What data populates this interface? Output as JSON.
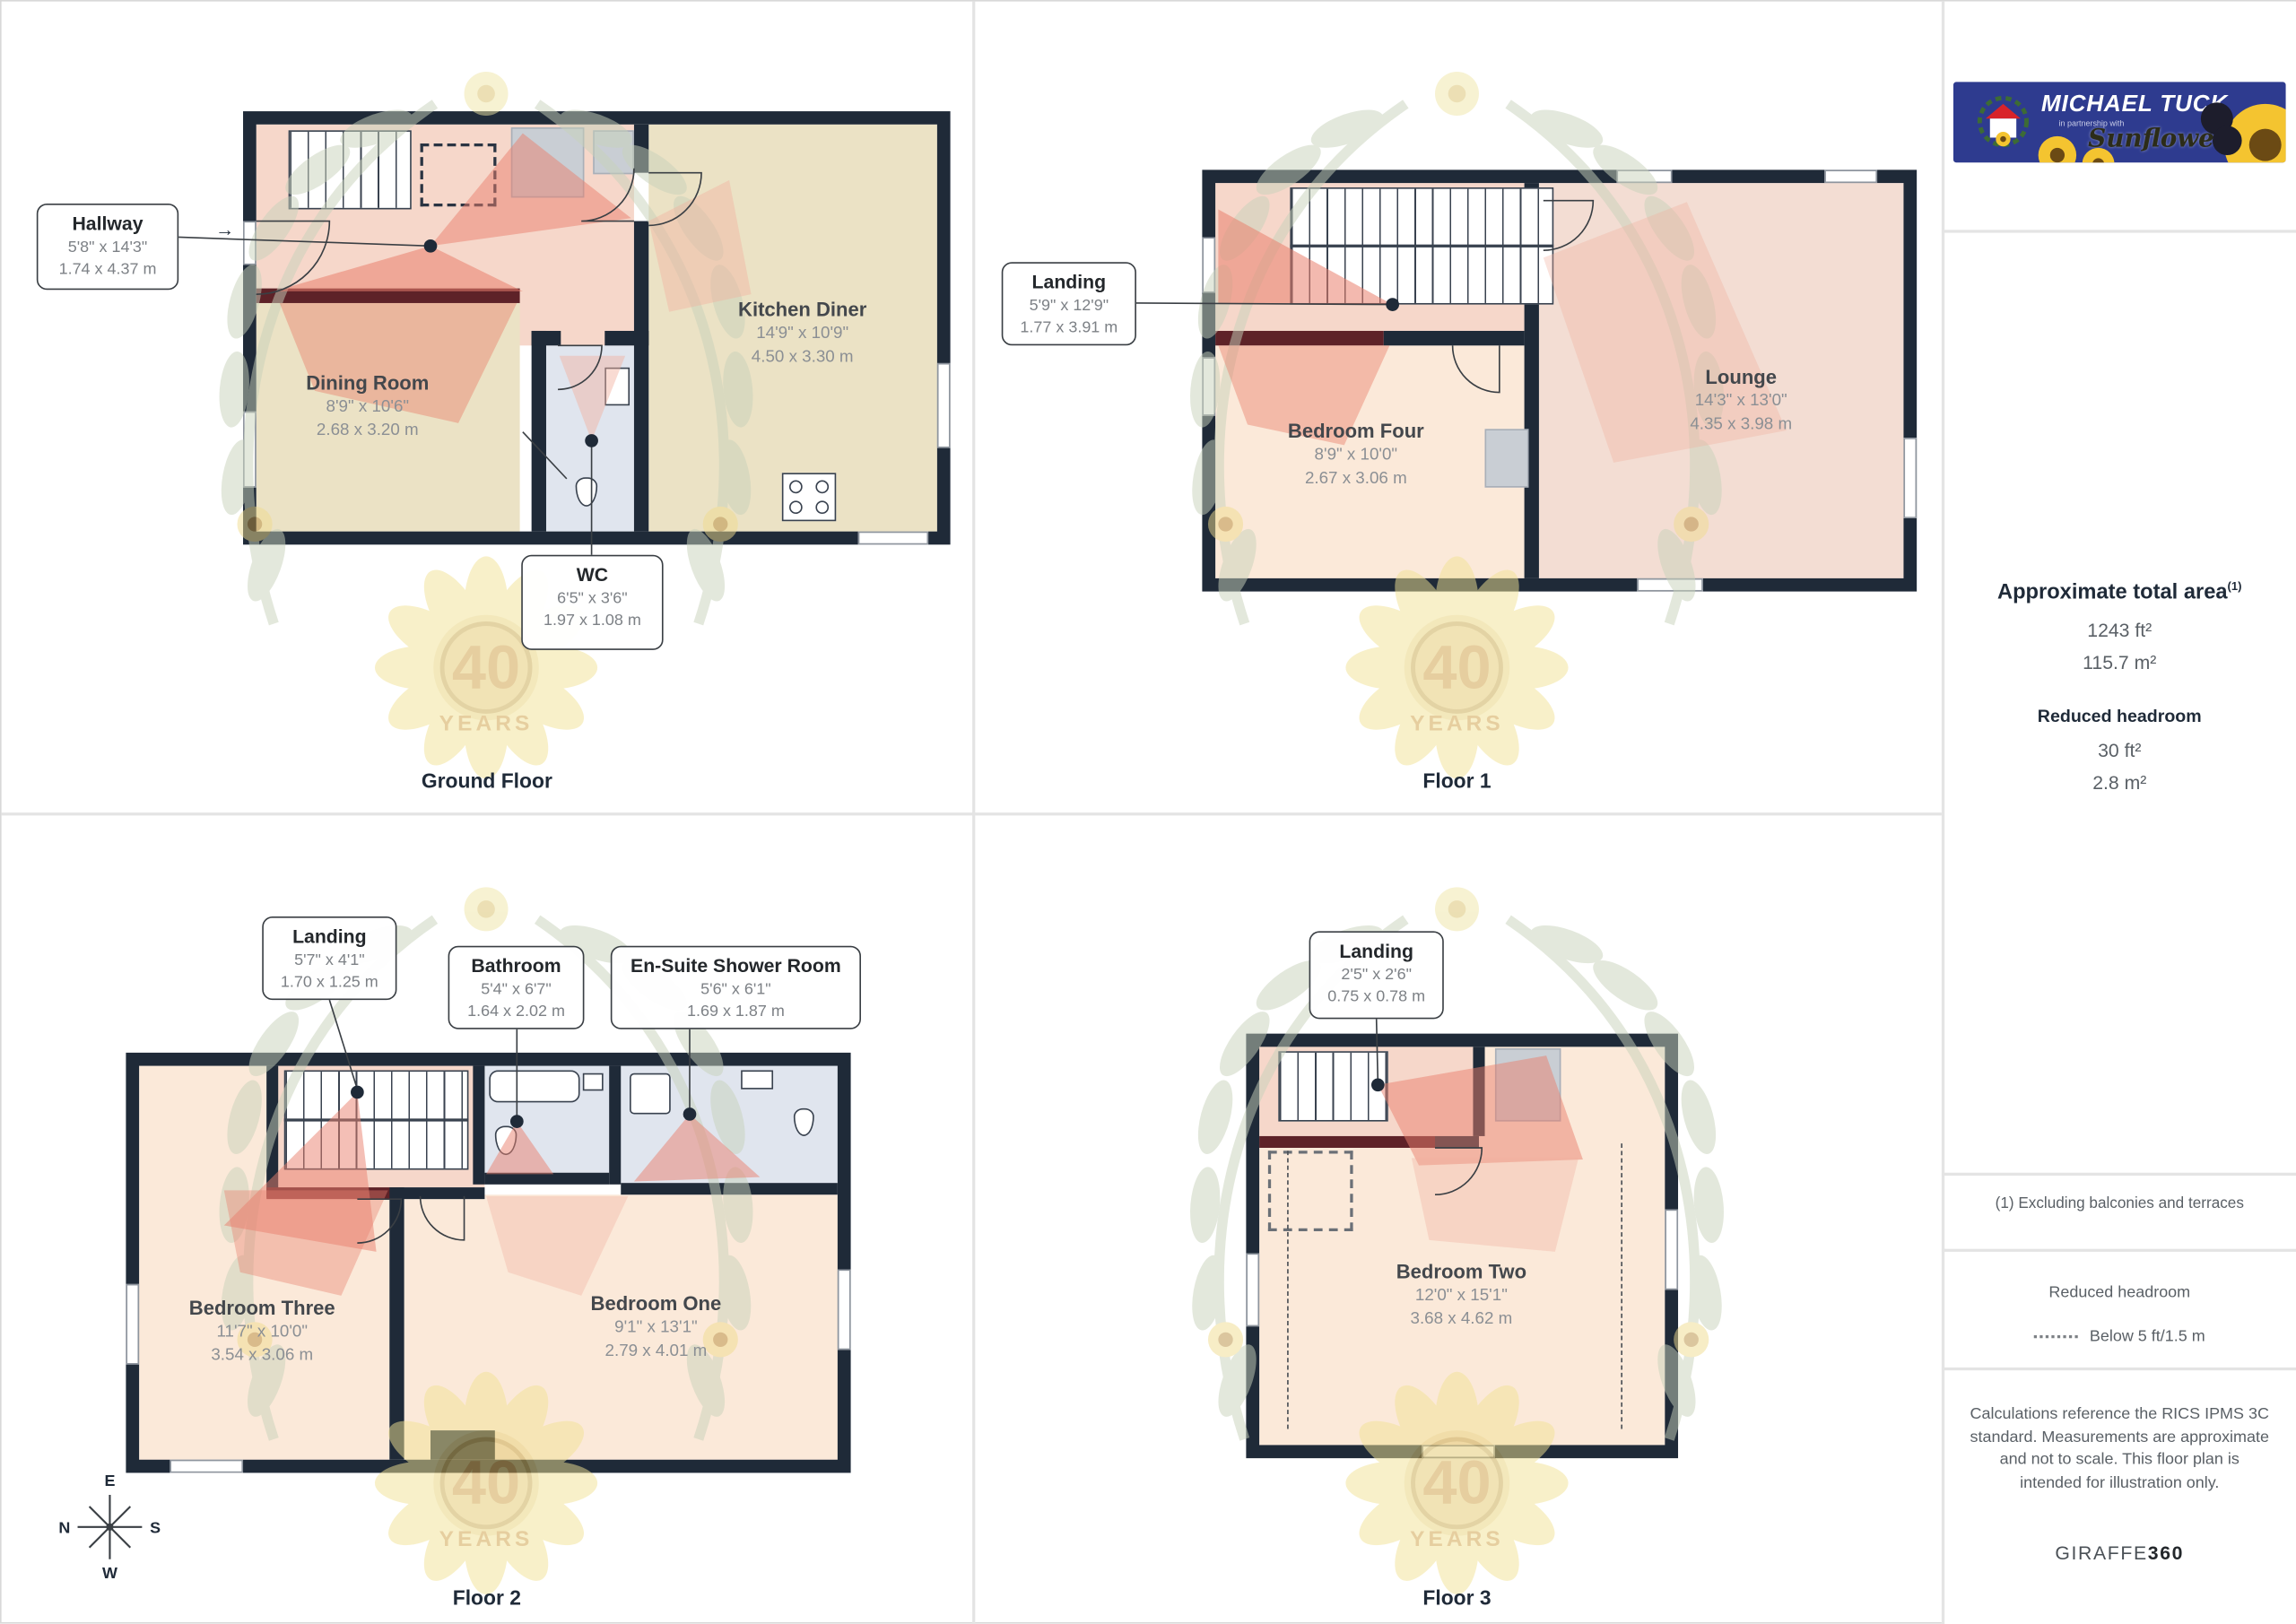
{
  "watermark": {
    "top": "40",
    "bottom": "YEARS"
  },
  "icons": {
    "entry_arrow": "→"
  },
  "compass": {
    "e": "E",
    "n": "N",
    "s": "S",
    "w": "W"
  },
  "panels": [
    {
      "floor_label": "Ground Floor",
      "rooms": {
        "hallway": {
          "name": "Hallway",
          "imperial": "5'8\" x 14'3\"",
          "metric": "1.74 x 4.37 m"
        },
        "dining": {
          "name": "Dining Room",
          "imperial": "8'9\" x 10'6\"",
          "metric": "2.68 x 3.20 m"
        },
        "kitchen": {
          "name": "Kitchen Diner",
          "imperial": "14'9\" x 10'9\"",
          "metric": "4.50 x 3.30 m"
        },
        "wc": {
          "name": "WC",
          "imperial": "6'5\" x 3'6\"",
          "metric": "1.97 x 1.08 m"
        }
      }
    },
    {
      "floor_label": "Floor 1",
      "rooms": {
        "landing": {
          "name": "Landing",
          "imperial": "5'9\" x 12'9\"",
          "metric": "1.77 x 3.91 m"
        },
        "bedroom_four": {
          "name": "Bedroom Four",
          "imperial": "8'9\" x 10'0\"",
          "metric": "2.67 x 3.06 m"
        },
        "lounge": {
          "name": "Lounge",
          "imperial": "14'3\" x 13'0\"",
          "metric": "4.35 x 3.98 m"
        }
      }
    },
    {
      "floor_label": "Floor 2",
      "rooms": {
        "landing": {
          "name": "Landing",
          "imperial": "5'7\" x 4'1\"",
          "metric": "1.70 x 1.25 m"
        },
        "bathroom": {
          "name": "Bathroom",
          "imperial": "5'4\" x 6'7\"",
          "metric": "1.64 x 2.02 m"
        },
        "ensuite": {
          "name": "En-Suite Shower Room",
          "imperial": "5'6\" x 6'1\"",
          "metric": "1.69 x 1.87 m"
        },
        "bedroom_three": {
          "name": "Bedroom Three",
          "imperial": "11'7\" x 10'0\"",
          "metric": "3.54 x 3.06 m"
        },
        "bedroom_one": {
          "name": "Bedroom One",
          "imperial": "9'1\" x 13'1\"",
          "metric": "2.79 x 4.01 m"
        }
      }
    },
    {
      "floor_label": "Floor 3",
      "rooms": {
        "landing": {
          "name": "Landing",
          "imperial": "2'5\" x 2'6\"",
          "metric": "0.75 x 0.78 m"
        },
        "bedroom_two": {
          "name": "Bedroom Two",
          "imperial": "12'0\" x 15'1\"",
          "metric": "3.68 x 4.62 m"
        }
      }
    }
  ],
  "sidebar": {
    "logo": {
      "brand": "MICHAEL TUCK",
      "partnership": "in partnership with",
      "script": "Sunflowers"
    },
    "area": {
      "title": "Approximate total area",
      "sup": "(1)",
      "ft": "1243 ft²",
      "m": "115.7 m²",
      "reduced_title": "Reduced headroom",
      "reduced_ft": "30 ft²",
      "reduced_m": "2.8 m²"
    },
    "note": "(1) Excluding balconies and terraces",
    "legend": {
      "title": "Reduced headroom",
      "label": "Below 5 ft/1.5 m"
    },
    "disclaimer": "Calculations reference the RICS IPMS 3C standard. Measurements are approximate and not to scale. This floor plan is intended for illustration only.",
    "footer": {
      "brand": "GIRAFFE",
      "suffix": "360"
    }
  }
}
